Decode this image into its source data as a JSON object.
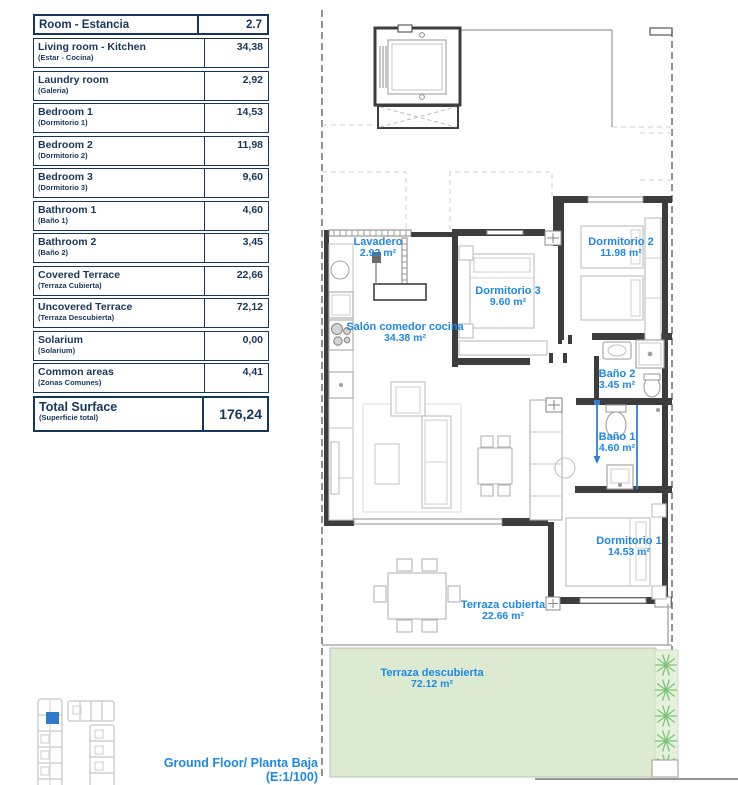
{
  "document": {
    "table": {
      "header_label": "Room - Estancia",
      "header_value": "2.7",
      "rows": [
        {
          "name": "Living room - Kitchen",
          "alt": "(Estar - Cocina)",
          "value": "34,38"
        },
        {
          "name": "Laundry room",
          "alt": "(Galeria)",
          "value": "2,92"
        },
        {
          "name": "Bedroom 1",
          "alt": "(Dormitorio 1)",
          "value": "14,53"
        },
        {
          "name": "Bedroom 2",
          "alt": "(Dormitorio 2)",
          "value": "11,98"
        },
        {
          "name": "Bedroom 3",
          "alt": "(Dormitorio 3)",
          "value": "9,60"
        },
        {
          "name": "Bathroom 1",
          "alt": "(Baño 1)",
          "value": "4,60"
        },
        {
          "name": "Bathroom 2",
          "alt": "(Baño 2)",
          "value": "3,45"
        },
        {
          "name": "Covered Terrace",
          "alt": "(Terraza Cubierta)",
          "value": "22,66"
        },
        {
          "name": "Uncovered Terrace",
          "alt": "(Terraza Descubierta)",
          "value": "72,12"
        },
        {
          "name": "Solarium",
          "alt": "(Solarium)",
          "value": "0,00"
        },
        {
          "name": "Common areas",
          "alt": "(Zonas Comunes)",
          "value": "4,41"
        }
      ],
      "total": {
        "name": "Total Surface",
        "alt": "(Superficie total)",
        "value": "176,24"
      }
    },
    "plan": {
      "labels": [
        {
          "name": "Lavadero",
          "area": "2.92 m²"
        },
        {
          "name": "Salón comedor cocina",
          "area": "34.38 m²"
        },
        {
          "name": "Dormitorio 3",
          "area": "9.60 m²"
        },
        {
          "name": "Dormitorio 2",
          "area": "11.98 m²"
        },
        {
          "name": "Baño 2",
          "area": "3.45 m²"
        },
        {
          "name": "Baño 1",
          "area": "4.60 m²"
        },
        {
          "name": "Dormitorio 1",
          "area": "14.53 m²"
        },
        {
          "name": "Terraza cubierta",
          "area": "22.66 m²"
        },
        {
          "name": "Terraza descubierta",
          "area": "72.12 m²"
        }
      ],
      "caption_line1": "Ground Floor/ Planta Baja",
      "caption_line2": "(E:1/100)"
    },
    "colors": {
      "table_navy": "#17365d",
      "label_blue": "#1e88e5",
      "terrace_green": "#dcead2",
      "plant_green": "#7cc47c",
      "keyplan_blue": "#2e7bcc"
    }
  }
}
